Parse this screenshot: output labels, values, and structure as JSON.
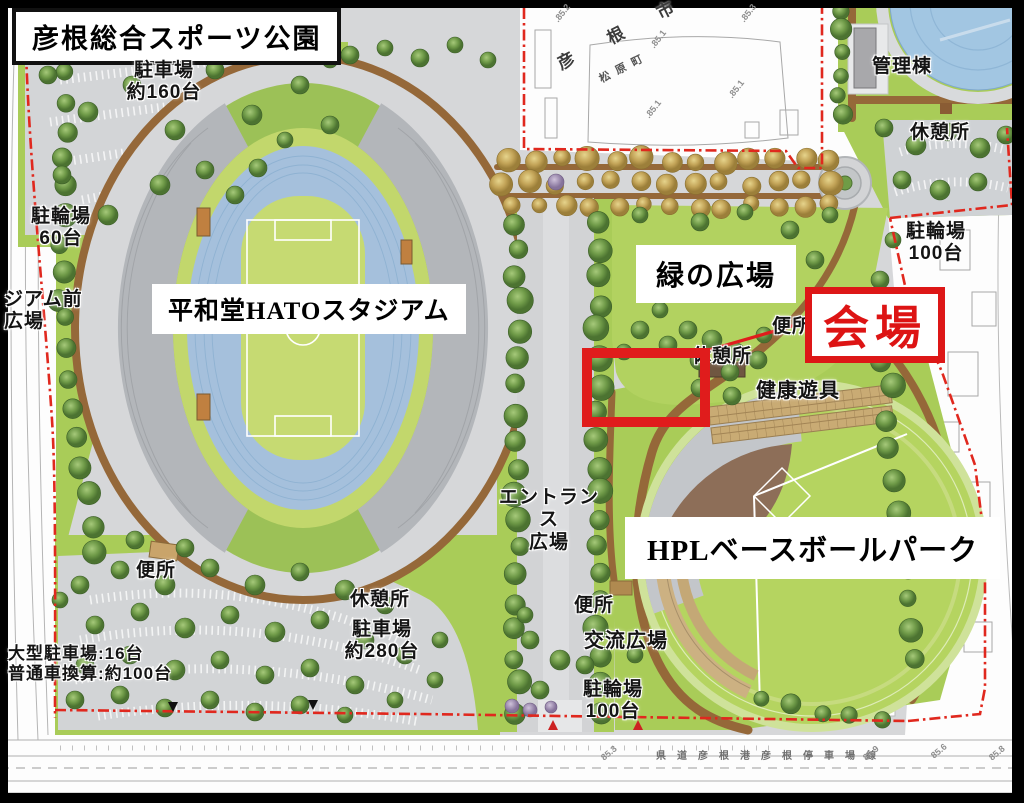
{
  "title": "彦根総合スポーツ公園",
  "facilities": {
    "stadium": "平和堂HATOスタジアム",
    "green_plaza": "緑の広場",
    "baseball_park": "HPLベースボールパーク",
    "venue": "会場",
    "entrance_plaza": "エントランス\n広場",
    "admin_building": "管理棟",
    "health_equipment": "健康遊具",
    "exchange_plaza": "交流広場",
    "stadium_front_plaza": "ジアム前\n広場"
  },
  "amenities": {
    "parking_160": "駐車場\n約160台",
    "parking_280": "駐車場\n約280台",
    "large_parking": "大型駐車場:16台\n普通車換算:約100台",
    "bike_60": "駐輪場\n60台",
    "bike_100_right": "駐輪場\n100台",
    "bike_100_bottom": "駐輪場\n100台",
    "toilet_mid": "便所",
    "toilet_bottom_left": "便所",
    "toilet_bottom_mid": "便所",
    "rest_top_right": "休憩所",
    "rest_mid": "休憩所",
    "rest_bottom": "休憩所"
  },
  "geo": {
    "city": "彦 根 市",
    "town": "松原町",
    "road": "県道彦根港彦根停車場線"
  },
  "elevations": [
    ".85.2",
    ".85.1",
    ".85.3",
    ".85.1",
    ".85.1",
    "85.3",
    "85.9",
    "85.6",
    "85.8"
  ],
  "colors": {
    "highlight_red": "#e01c1c",
    "venue_text_red": "#dd1414",
    "grass": "#a9cc58",
    "field_green": "#c6da72",
    "track_blue": "#a5c0dc",
    "road_brown": "#956839",
    "pavement": "#d6d7d9"
  }
}
